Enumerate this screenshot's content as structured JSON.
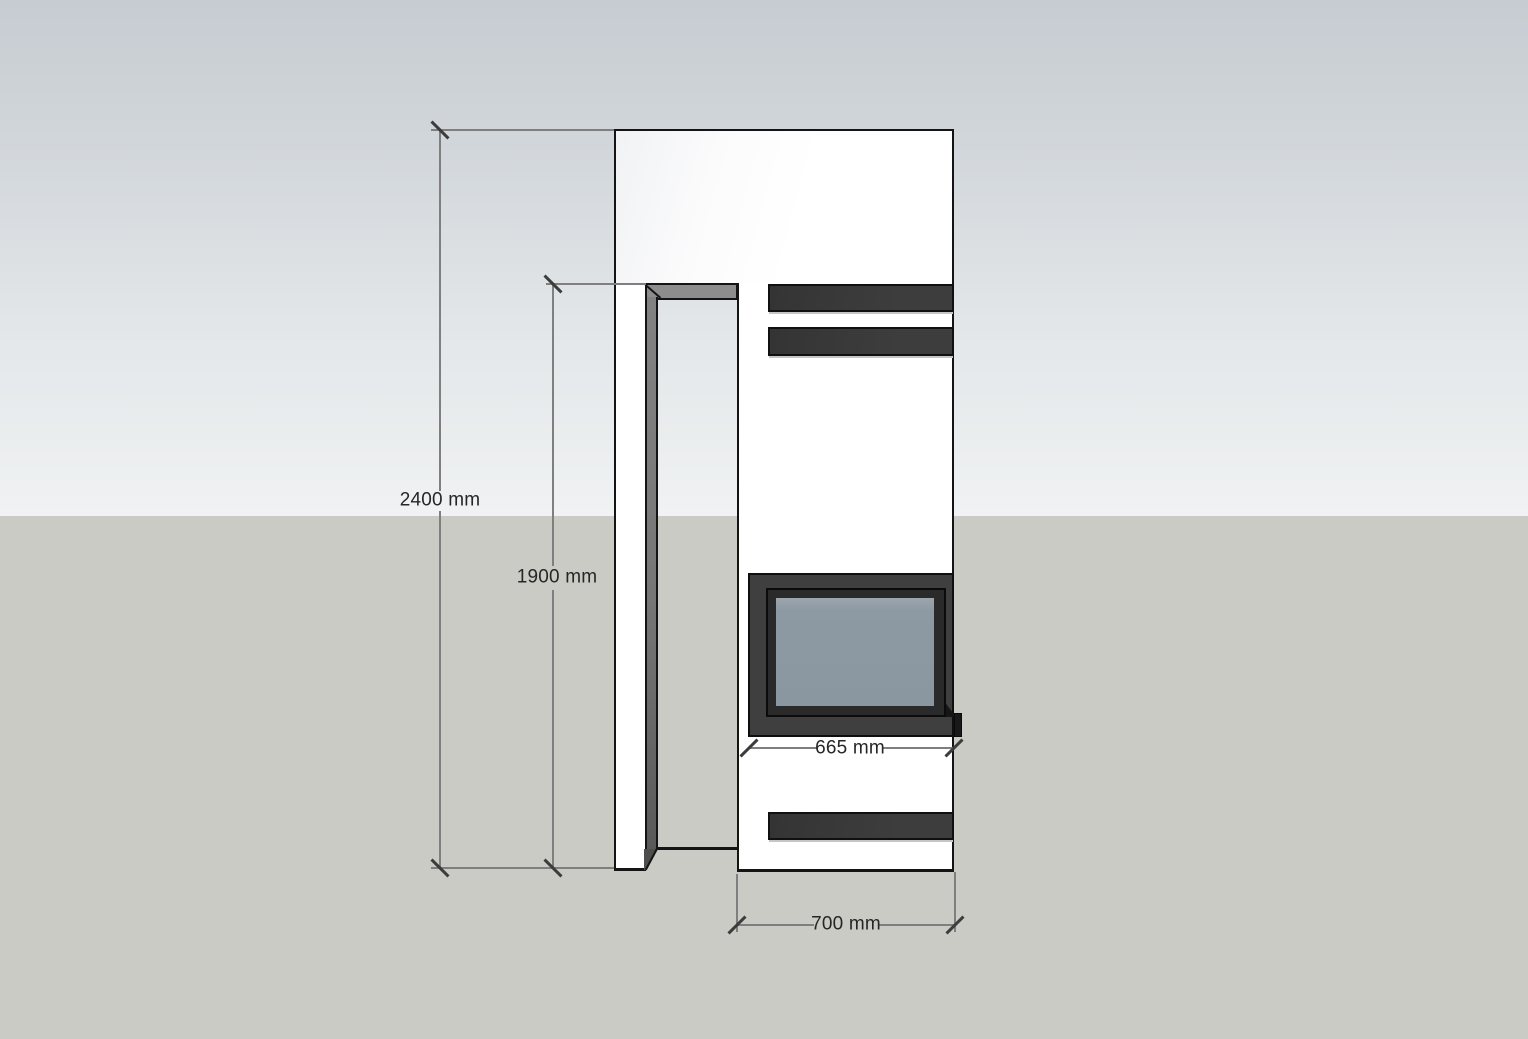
{
  "dimensions": {
    "overall_height": "2400 mm",
    "opening_height": "1900 mm",
    "firebox_width": "665 mm",
    "base_width": "700 mm"
  },
  "colors": {
    "sky_top": "#c6ccd1",
    "sky_horizon": "#f0f2f3",
    "ground": "#cbcbc5",
    "face_white": "#ffffff",
    "edge_black": "#141414",
    "vent_bar_dark": "#3b3b3b",
    "niche_gray": "#8d8d8d",
    "glass_blue_gray": "#8d99a3",
    "dimension_line_gray": "#7f7f7f",
    "dimension_text": "#262626"
  }
}
